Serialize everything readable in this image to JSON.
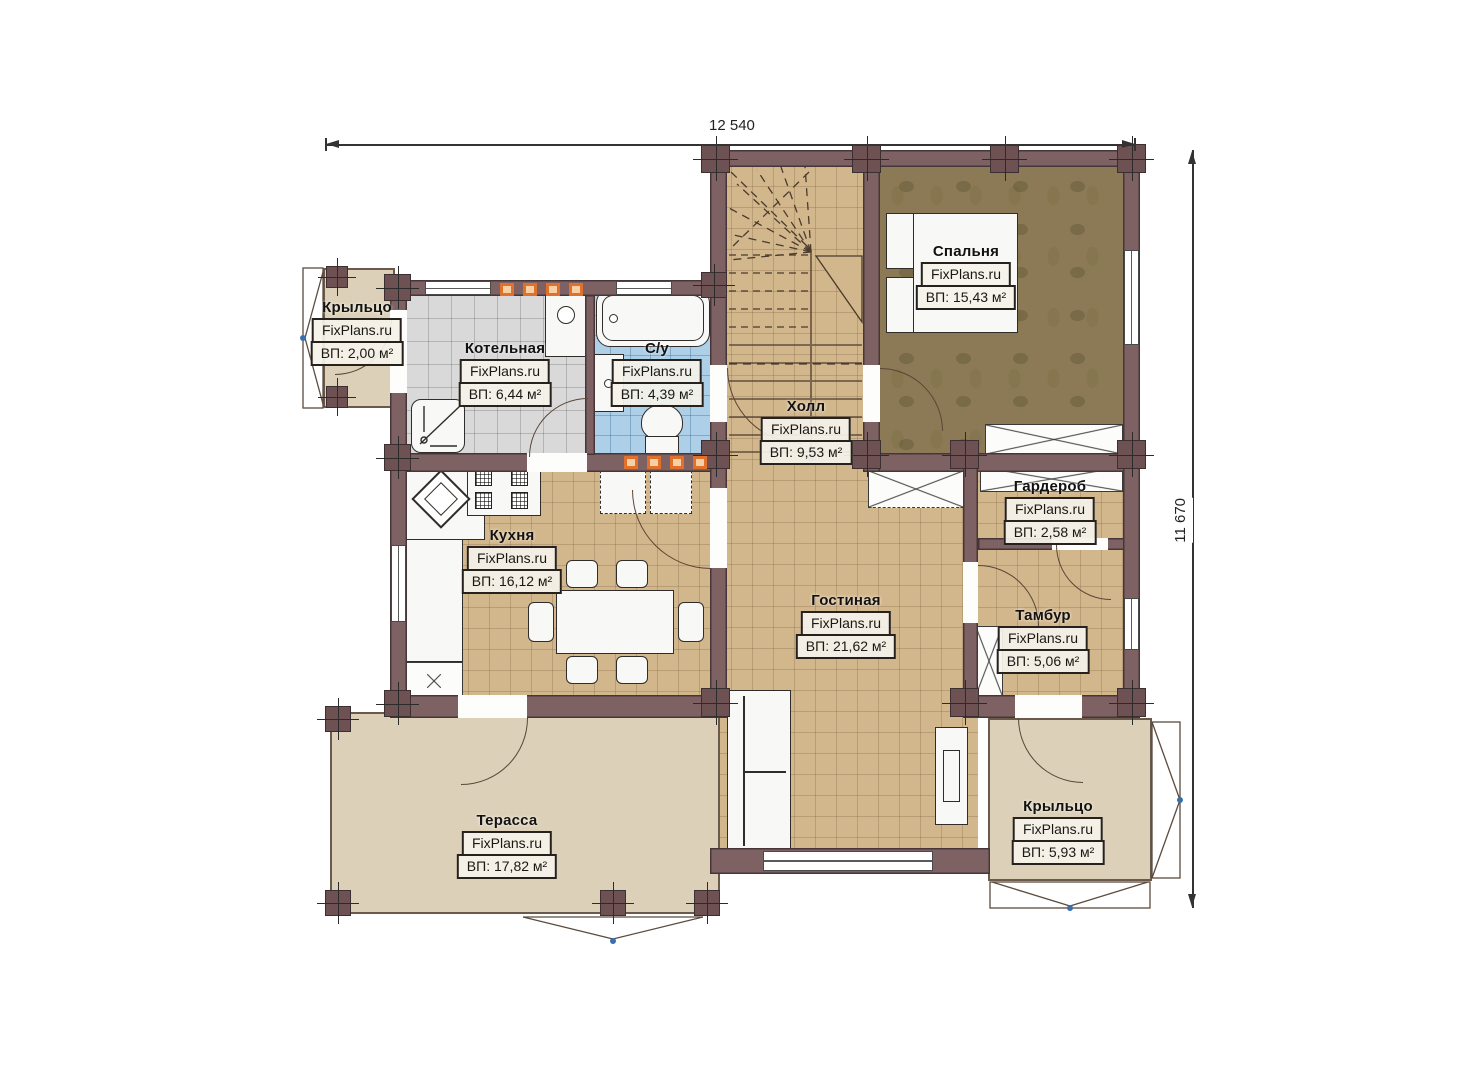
{
  "watermark": "FixPlans.ru",
  "dimensions": {
    "top": "12 540",
    "right": "11 670"
  },
  "rooms": [
    {
      "name": "Крыльцо",
      "area": "ВП: 2,00 м²"
    },
    {
      "name": "Котельная",
      "area": "ВП: 6,44 м²"
    },
    {
      "name": "С/у",
      "area": "ВП: 4,39 м²"
    },
    {
      "name": "Холл",
      "area": "ВП: 9,53 м²"
    },
    {
      "name": "Спальня",
      "area": "ВП: 15,43 м²"
    },
    {
      "name": "Гардероб",
      "area": "ВП: 2,58 м²"
    },
    {
      "name": "Кухня",
      "area": "ВП: 16,12 м²"
    },
    {
      "name": "Гостиная",
      "area": "ВП: 21,62 м²"
    },
    {
      "name": "Тамбур",
      "area": "ВП: 5,06 м²"
    },
    {
      "name": "Крыльцо",
      "area": "ВП: 5,93 м²"
    },
    {
      "name": "Терасса",
      "area": "ВП: 17,82 м²"
    }
  ],
  "colors": {
    "wall": "#7d6163",
    "floor_tile": "#d3b78c",
    "floor_bedroom": "#8b7a55",
    "floor_bath": "#adcfe7",
    "floor_boiler": "#d9d9d9",
    "floor_porch": "#dcd0b8",
    "vent_accent": "#e0712c"
  }
}
